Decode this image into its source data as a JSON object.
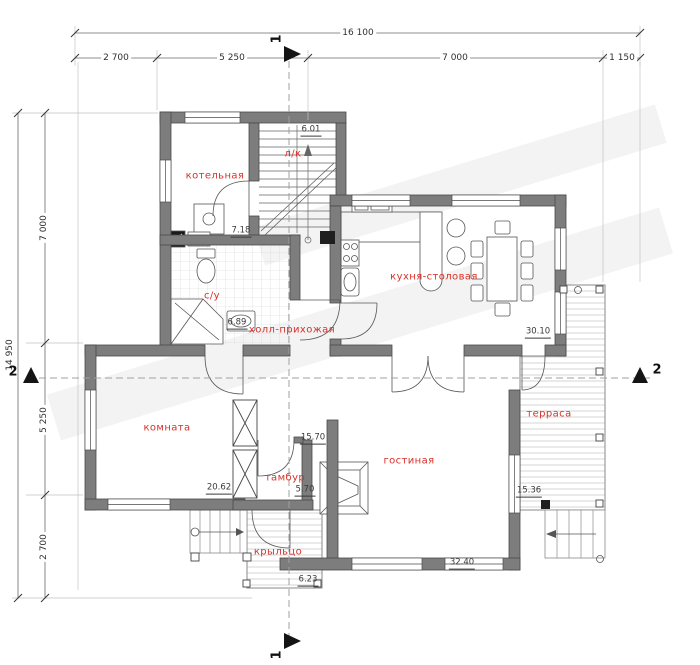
{
  "plan": {
    "dims": {
      "top_total": "16 100",
      "top_segments": [
        "2 700",
        "5 250",
        "7 000",
        "1 150"
      ],
      "left_total": "14 950",
      "left_segments": [
        "7 000",
        "5 250",
        "2 700"
      ]
    },
    "sections": {
      "top": "1",
      "bottom": "1",
      "left": "2",
      "right": "2"
    },
    "rooms": [
      {
        "name": "котельная",
        "area": "7.18"
      },
      {
        "name": "л/к",
        "area": "6.01"
      },
      {
        "name": "с/у",
        "area": "6.89"
      },
      {
        "name": "холл-прихожая",
        "area": "15.70"
      },
      {
        "name": "кухня-столовая",
        "area": "30.10"
      },
      {
        "name": "комната",
        "area": "20.62"
      },
      {
        "name": "тамбур",
        "area": "5.70"
      },
      {
        "name": "гостиная",
        "area": "32.40"
      },
      {
        "name": "терраса",
        "area": "15.36"
      },
      {
        "name": "крыльцо",
        "area": "6.23"
      }
    ],
    "colors": {
      "room_label": "#d93129",
      "walls": "#7d7d7d",
      "dimension_text": "#2f2f2f"
    }
  }
}
